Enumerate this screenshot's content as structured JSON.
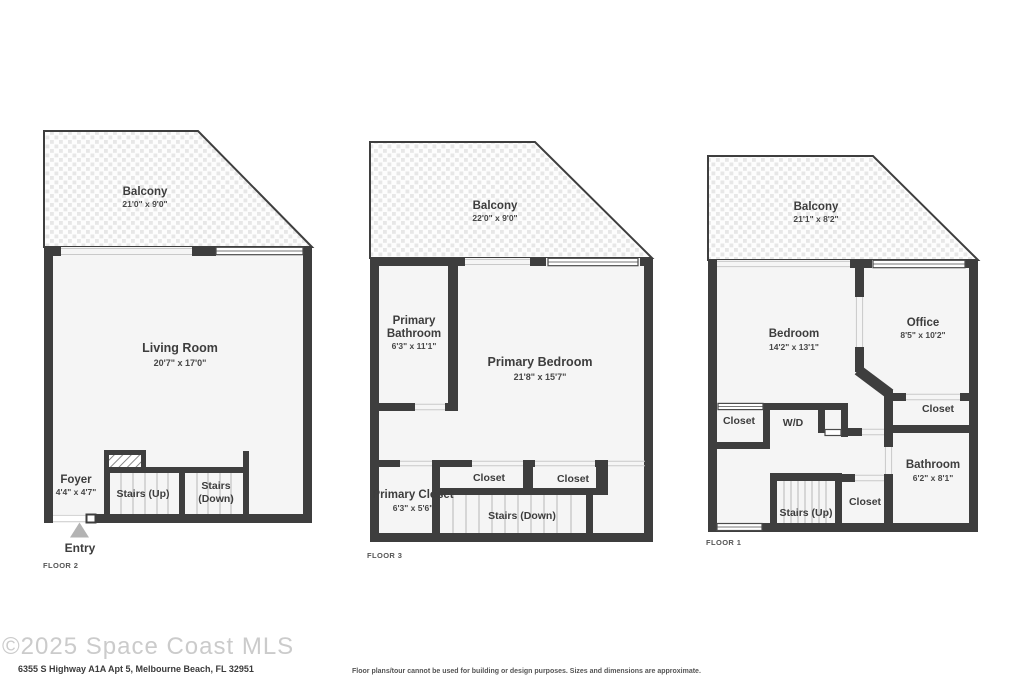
{
  "floor2": {
    "label": "FLOOR 2",
    "balcony_name": "Balcony",
    "balcony_dims": "21'0\" x 9'0\"",
    "living_room_name": "Living Room",
    "living_room_dims": "20'7\" x 17'0\"",
    "foyer_name": "Foyer",
    "foyer_dims": "4'4\" x 4'7\"",
    "stairs_up": "Stairs (Up)",
    "stairs_down_line1": "Stairs",
    "stairs_down_line2": "(Down)",
    "entry": "Entry"
  },
  "floor3": {
    "label": "FLOOR 3",
    "balcony_name": "Balcony",
    "balcony_dims": "22'0\" x 9'0\"",
    "primary_bathroom_line1": "Primary",
    "primary_bathroom_line2": "Bathroom",
    "primary_bathroom_dims": "6'3\" x 11'1\"",
    "primary_bedroom_name": "Primary Bedroom",
    "primary_bedroom_dims": "21'8\" x 15'7\"",
    "closet_1": "Closet",
    "closet_2": "Closet",
    "primary_closet_name": "Primary Closet",
    "primary_closet_dims": "6'3\" x 5'6\"",
    "stairs_down": "Stairs (Down)"
  },
  "floor1": {
    "label": "FLOOR 1",
    "balcony_name": "Balcony",
    "balcony_dims": "21'1\" x 8'2\"",
    "bedroom_name": "Bedroom",
    "bedroom_dims": "14'2\" x 13'1\"",
    "office_name": "Office",
    "office_dims": "8'5\" x 10'2\"",
    "closet_office": "Closet",
    "closet_bedroom": "Closet",
    "wd": "W/D",
    "bathroom_name": "Bathroom",
    "bathroom_dims": "6'2\" x 8'1\"",
    "stairs_up": "Stairs (Up)",
    "closet_stairs": "Closet"
  },
  "footer": {
    "watermark": "©2025 Space Coast MLS",
    "address": "6355 S Highway A1A Apt 5, Melbourne Beach, FL 32951",
    "disclaimer": "Floor plans/tour cannot be used for building or design purposes. Sizes and dimensions are approximate."
  },
  "colors": {
    "wall": "#3e3e3e",
    "floor_fill": "#f5f5f5",
    "balcony_tile": "#e7e7e7",
    "text": "#3d3d3d",
    "entry_arrow": "#b3b3b3",
    "watermark": "#cbcbcb"
  }
}
